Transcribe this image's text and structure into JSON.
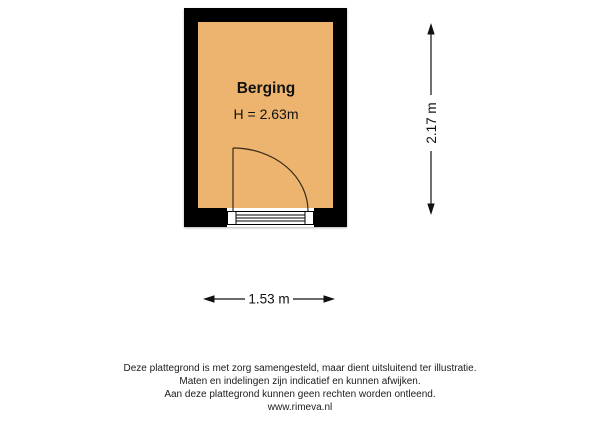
{
  "plan": {
    "room": {
      "name": "Berging",
      "ceiling_height_label": "H = 2.63m"
    },
    "dimensions": {
      "width_label": "1.53 m",
      "height_label": "2.17 m"
    },
    "colors": {
      "room_fill": "#ECB46E",
      "wall": "#000000"
    }
  },
  "footer": {
    "line1": "Deze plattegrond is met zorg samengesteld, maar dient uitsluitend ter illustratie.",
    "line2": "Maten en indelingen zijn indicatief en kunnen afwijken.",
    "line3": "Aan deze plattegrond kunnen geen rechten worden ontleend.",
    "website": "www.rimeva.nl"
  }
}
